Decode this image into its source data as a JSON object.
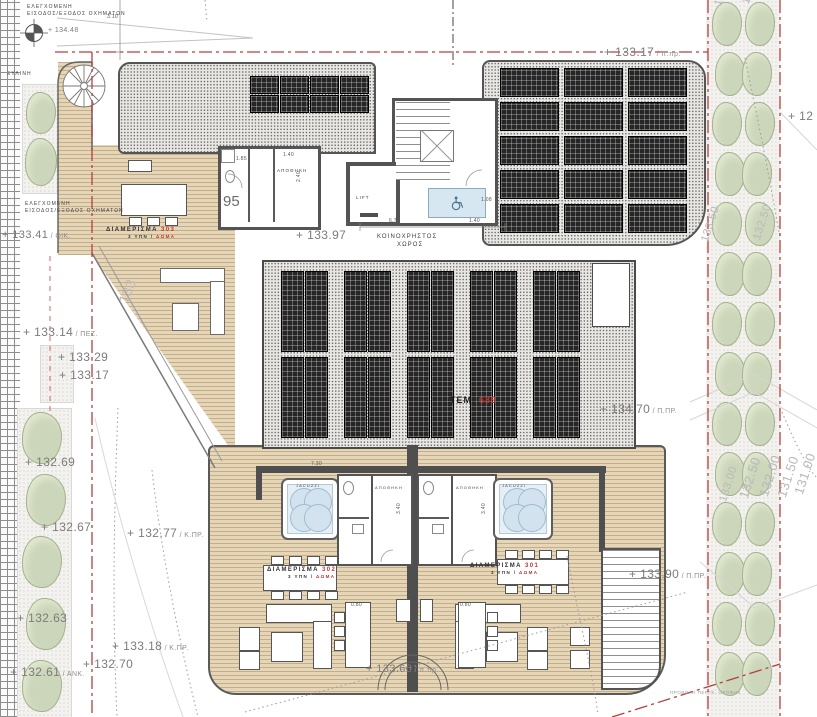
{
  "drawing_colors": {
    "boundary_red": "#b34040",
    "deck": "#e6d6b8",
    "solar_panel": "#262626",
    "water": "#e6eff6",
    "vegetation": "#ccd6ba"
  },
  "annotations": [
    {
      "name": "vehicle-entry-label-1a",
      "t": "ΕΛΕΓΧΟΜΕΝΗ",
      "x": 27,
      "y": 5,
      "cls": "roomlbl"
    },
    {
      "name": "vehicle-entry-label-1b",
      "t": "ΕΙΣΟΔΟΣ/ΕΞΟΔΟΣ ΟΧΗΜΑΤΩΝ",
      "x": 27,
      "y": 12,
      "cls": "roomlbl"
    },
    {
      "name": "benchmark-elevation",
      "t": "+ 134.48",
      "x": 48,
      "y": 27,
      "cls": "elev sm"
    },
    {
      "name": "dim-3-10",
      "t": "3.10",
      "x": 107,
      "y": 15,
      "cls": "dim"
    },
    {
      "name": "wooden-pergola-label",
      "t": "ΞΥΛΙΝΗ",
      "x": 7,
      "y": 72,
      "cls": "roomlbl"
    },
    {
      "name": "vehicle-entry-label-2a",
      "t": "ΕΛΕΓΧΟΜΕΝΗ",
      "x": 25,
      "y": 202,
      "cls": "roomlbl"
    },
    {
      "name": "vehicle-entry-label-2b",
      "t": "ΕΙΣΟΔΟΣ/ΕΞΟΔΟΣ ΟΧΗΜΑΤΩΝ",
      "x": 25,
      "y": 209,
      "cls": "roomlbl"
    },
    {
      "name": "elev-133-41",
      "t": "+ 133.41",
      "suf": "/ ΟΙΚ.",
      "x": 2,
      "y": 230,
      "cls": "elev",
      "fs": 11
    },
    {
      "name": "elev-133-97",
      "t": "+ 133.97",
      "x": 296,
      "y": 229,
      "cls": "elev"
    },
    {
      "name": "communal-space-label-1",
      "t": "ΚΟΙΝΟΧΡΗΣΤΟΣ",
      "x": 377,
      "y": 234,
      "cls": "roomlbl",
      "fs": 6
    },
    {
      "name": "communal-space-label-2",
      "t": "ΧΩΡΟΣ",
      "x": 397,
      "y": 242,
      "cls": "roomlbl",
      "fs": 6
    },
    {
      "name": "elev-133-17-top",
      "t": "+ 133.17",
      "suf": "/ π.πρ.",
      "x": 604,
      "y": 46,
      "cls": "elev"
    },
    {
      "name": "elev-12",
      "t": "+ 12",
      "x": 788,
      "y": 110,
      "cls": "elev"
    },
    {
      "name": "apt-303-label",
      "t": "ΔΙΑΜΕΡΙΣΜΑ",
      "t2": "303",
      "x": 106,
      "y": 227,
      "cls": "apt"
    },
    {
      "name": "apt-303-sub",
      "t": "3 ΥΠΝ /",
      "t2": "ΔΩΜΑ",
      "x": 128,
      "y": 235,
      "cls": "apt",
      "fs": 4.5
    },
    {
      "name": "storage-label-top",
      "t": "ΑΠΟΘΗΚΗ",
      "x": 277,
      "y": 169,
      "cls": "roomlbl",
      "fs": 4.5
    },
    {
      "name": "room-number-95",
      "t": "95",
      "x": 223,
      "y": 194,
      "cls": "big95"
    },
    {
      "name": "lift-label",
      "t": "LIFT",
      "x": 356,
      "y": 196,
      "cls": "roomlbl",
      "fs": 4.5
    },
    {
      "name": "dim-6-78",
      "t": "6.78",
      "x": 389,
      "y": 219,
      "cls": "dim"
    },
    {
      "name": "dim-1-40-a",
      "t": "1.40",
      "x": 469,
      "y": 219,
      "cls": "dim"
    },
    {
      "name": "dim-1-40-b",
      "t": "1.40",
      "x": 283,
      "y": 153,
      "cls": "dim"
    },
    {
      "name": "dim-1-85",
      "t": "1.85",
      "x": 236,
      "y": 157,
      "cls": "dim"
    },
    {
      "name": "dim-2-40",
      "t": "2.40",
      "x": 297,
      "y": 182,
      "cls": "dim",
      "rot": -90
    },
    {
      "name": "dim-1-08",
      "t": "1.08",
      "x": 481,
      "y": 198,
      "cls": "dim"
    },
    {
      "name": "elev-133-14",
      "t": "+ 133.14",
      "suf": "/ ΠΕΖ.",
      "x": 23,
      "y": 326,
      "cls": "elev"
    },
    {
      "name": "elev-133-29",
      "t": "+ 133.29",
      "x": 58,
      "y": 351,
      "cls": "elev"
    },
    {
      "name": "elev-133-17",
      "t": "+ 133.17",
      "x": 59,
      "y": 369,
      "cls": "elev"
    },
    {
      "name": "contour-133-diag",
      "t": "133",
      "x": 116,
      "y": 300,
      "cls": "contour",
      "rot": -68,
      "fs": 14
    },
    {
      "name": "tem-count",
      "t": "ΤΕΜ.",
      "t2": "689",
      "x": 450,
      "y": 396,
      "cls": "tem"
    },
    {
      "name": "elev-134-70",
      "t": "+ 134.70",
      "suf": "/ Π.ΠΡ.",
      "x": 600,
      "y": 403,
      "cls": "elev"
    },
    {
      "name": "elev-132-69",
      "t": "+ 132.69",
      "x": 25,
      "y": 456,
      "cls": "elev"
    },
    {
      "name": "dim-7-30",
      "t": "7.30",
      "x": 311,
      "y": 462,
      "cls": "dim"
    },
    {
      "name": "storage-302-label",
      "t": "ΑΠΟΘΗΚΗ",
      "x": 375,
      "y": 486,
      "cls": "roomlbl",
      "fs": 4
    },
    {
      "name": "storage-301-label",
      "t": "ΑΠΟΘΗΚΗ",
      "x": 456,
      "y": 486,
      "cls": "roomlbl",
      "fs": 4
    },
    {
      "name": "jacuzzi-302-label",
      "t": "JACUZZI",
      "x": 296,
      "y": 484,
      "cls": "roomlbl",
      "fs": 4
    },
    {
      "name": "jacuzzi-301-label",
      "t": "JACUZZI",
      "x": 502,
      "y": 484,
      "cls": "roomlbl",
      "fs": 4
    },
    {
      "name": "dim-3-40-a",
      "t": "3.40",
      "x": 397,
      "y": 514,
      "cls": "dim",
      "rot": -90
    },
    {
      "name": "dim-3-40-b",
      "t": "3.40",
      "x": 482,
      "y": 514,
      "cls": "dim",
      "rot": -90
    },
    {
      "name": "elev-132-67",
      "t": "+ 132.67",
      "x": 41,
      "y": 521,
      "cls": "elev"
    },
    {
      "name": "elev-132-77",
      "t": "+ 132.77",
      "suf": "/ Κ.ΠΡ.",
      "x": 127,
      "y": 527,
      "cls": "elev"
    },
    {
      "name": "apt-302-label",
      "t": "ΔΙΑΜΕΡΙΣΜΑ",
      "t2": "302",
      "x": 267,
      "y": 567,
      "cls": "apt"
    },
    {
      "name": "apt-302-sub",
      "t": "3 ΥΠΝ /",
      "t2": "ΔΩΜΑ",
      "x": 288,
      "y": 575,
      "cls": "apt",
      "fs": 4.5
    },
    {
      "name": "apt-301-label",
      "t": "ΔΙΑΜΕΡΙΣΜΑ",
      "t2": "301",
      "x": 470,
      "y": 563,
      "cls": "apt"
    },
    {
      "name": "apt-301-sub",
      "t": "3 ΥΠΝ /",
      "t2": "ΔΩΜΑ",
      "x": 491,
      "y": 571,
      "cls": "apt",
      "fs": 4.5
    },
    {
      "name": "elev-133-90",
      "t": "+ 133.90",
      "suf": "/ Π.ΠΡ.",
      "x": 629,
      "y": 568,
      "cls": "elev"
    },
    {
      "name": "dim-0-80-a",
      "t": "0.80",
      "x": 351,
      "y": 603,
      "cls": "dim"
    },
    {
      "name": "dim-0-80-b",
      "t": "0.80",
      "x": 460,
      "y": 603,
      "cls": "dim"
    },
    {
      "name": "elev-132-63",
      "t": "+ 132.63",
      "x": 17,
      "y": 612,
      "cls": "elev"
    },
    {
      "name": "elev-133-18",
      "t": "+ 133.18",
      "suf": "/ Κ.ΠΡ.",
      "x": 112,
      "y": 640,
      "cls": "elev"
    },
    {
      "name": "elev-132-70",
      "t": "+ 132.70",
      "x": 83,
      "y": 658,
      "cls": "elev"
    },
    {
      "name": "elev-132-61",
      "t": "+ 132.61",
      "suf": "/ ΑΝΚ.",
      "x": 10,
      "y": 666,
      "cls": "elev"
    },
    {
      "name": "elev-133-66",
      "t": "+ 133.66",
      "suf": "/ π.πρ.",
      "x": 366,
      "y": 664,
      "cls": "elev",
      "fs": 11
    },
    {
      "name": "roof-projection-label",
      "t": "ΠΡΟΒΟΛΗ ΠΕΡΓΚ. ΟΡΟΦΗΣ",
      "x": 670,
      "y": 691,
      "cls": "tiny-gray"
    },
    {
      "name": "contour-133-50-top",
      "t": "133.50",
      "x": 713,
      "y": 4,
      "cls": "contour",
      "rot": -72
    },
    {
      "name": "contour-132-50-top",
      "t": "132.50",
      "x": 741,
      "y": 2,
      "cls": "contour",
      "rot": -72
    },
    {
      "name": "contour-133-50-mid",
      "t": "133.50",
      "x": 700,
      "y": 240,
      "cls": "contour",
      "rot": -72
    },
    {
      "name": "contour-132-50-mid",
      "t": "132.50",
      "x": 752,
      "y": 238,
      "cls": "contour",
      "rot": -72
    },
    {
      "name": "contour-133-00-bot",
      "t": "133.00",
      "x": 718,
      "y": 500,
      "cls": "contour",
      "rot": -72
    },
    {
      "name": "contour-132-50-bot",
      "t": "132.50",
      "x": 737,
      "y": 496,
      "cls": "contour",
      "rot": -72,
      "fs": 13
    },
    {
      "name": "contour-132-00-bot",
      "t": "132.00",
      "x": 757,
      "y": 494,
      "cls": "contour",
      "rot": -72,
      "fs": 13
    },
    {
      "name": "contour-131-50-bot",
      "t": "131.50",
      "x": 775,
      "y": 495,
      "cls": "contour",
      "rot": -72,
      "fs": 13
    },
    {
      "name": "contour-131-00-bot",
      "t": "131.00",
      "x": 792,
      "y": 492,
      "cls": "contour",
      "rot": -72,
      "fs": 13
    }
  ],
  "solar_arrays": {
    "top_left": {
      "x": 250,
      "y": 76,
      "cols": 4,
      "rows": 2,
      "cell_w": 27,
      "cell_h": 16,
      "gap_x": 3,
      "gap_y": 3
    },
    "top_right": {
      "x": 500,
      "y": 68,
      "cols": 3,
      "rows": 5,
      "cell_w": 57,
      "cell_h": 27,
      "gap_x": 7,
      "gap_y": 7
    },
    "central": {
      "x": 281,
      "groups": 5,
      "strips_per_group": 2,
      "group_pitch": 63,
      "strip_w": 21,
      "strip_gap": 3,
      "strip_h": 79,
      "row_y": [
        271,
        357
      ]
    }
  },
  "vegetation": {
    "left_top_planter": {
      "bushes": [
        [
          26,
          92,
          30,
          42
        ],
        [
          25,
          138,
          32,
          48
        ]
      ]
    },
    "left_long_planter": {
      "x": 24,
      "w": 40,
      "h": 52,
      "start_y": 412,
      "pitch": 62,
      "count": 5
    },
    "right_strip": {
      "cols": [
        712,
        742
      ],
      "w": 30,
      "h": 44,
      "start_y": 2,
      "pitch": 50,
      "count": 14
    }
  }
}
